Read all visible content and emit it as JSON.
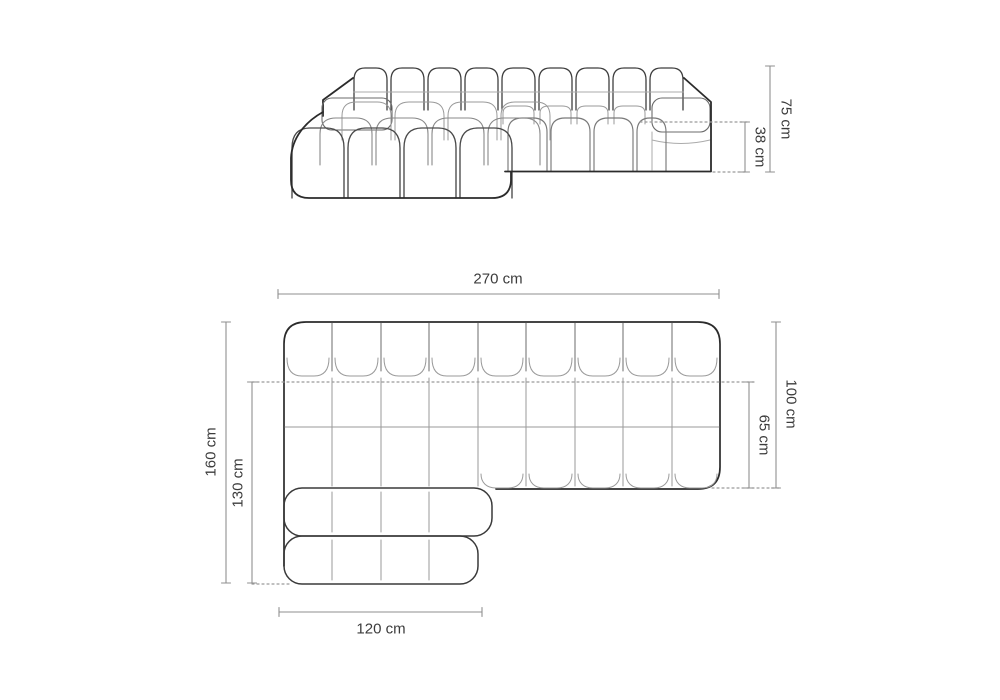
{
  "diagram_title": "Sectional chaise sofa dimension drawing",
  "front_view": {
    "overall_height_label": "75 cm",
    "seat_height_label": "38 cm"
  },
  "top_view": {
    "overall_width_label": "270 cm",
    "overall_depth_label": "160 cm",
    "chaise_depth_label": "130 cm",
    "chaise_width_label": "120 cm",
    "body_depth_label": "100 cm",
    "seat_depth_label": "65 cm"
  },
  "colors": {
    "outline": "#2b2b2b",
    "medium_line": "#666666",
    "inner_line": "#9a9a9a",
    "dimension_line": "#8f8f8f",
    "label_text": "#3c3c3c",
    "background": "#ffffff"
  }
}
